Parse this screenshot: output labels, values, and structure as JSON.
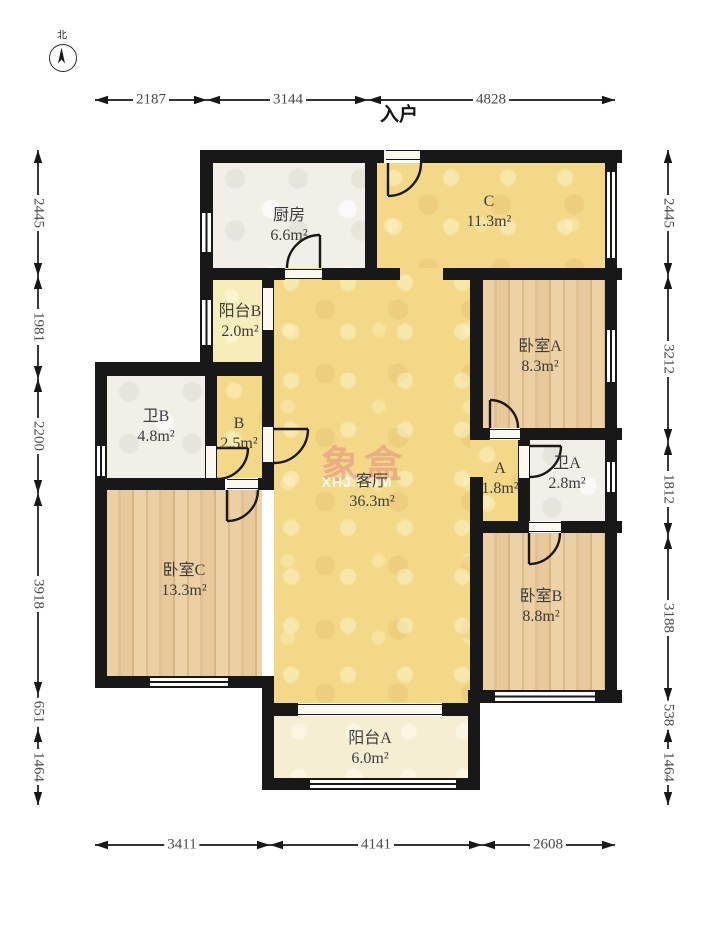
{
  "compass": {
    "label": "北"
  },
  "entry": {
    "label": "入户"
  },
  "watermark": {
    "line1": "象盒",
    "line2": "XHJ.COM"
  },
  "rooms": [
    {
      "id": "kitchen",
      "name": "厨房",
      "area": "6.6m²"
    },
    {
      "id": "hall-c",
      "name": "C",
      "area": "11.3m²"
    },
    {
      "id": "balcony-b",
      "name": "阳台B",
      "area": "2.0m²"
    },
    {
      "id": "bedroom-a",
      "name": "卧室A",
      "area": "8.3m²"
    },
    {
      "id": "bath-b",
      "name": "卫B",
      "area": "4.8m²"
    },
    {
      "id": "hall-b",
      "name": "B",
      "area": "2.5m²"
    },
    {
      "id": "living",
      "name": "客厅",
      "area": "36.3m²"
    },
    {
      "id": "hall-a",
      "name": "A",
      "area": "1.8m²"
    },
    {
      "id": "bath-a",
      "name": "卫A",
      "area": "2.8m²"
    },
    {
      "id": "bedroom-c",
      "name": "卧室C",
      "area": "13.3m²"
    },
    {
      "id": "bedroom-b",
      "name": "卧室B",
      "area": "8.8m²"
    },
    {
      "id": "balcony-a",
      "name": "阳台A",
      "area": "6.0m²"
    }
  ],
  "dimensions": {
    "top": [
      "2187",
      "3144",
      "4828"
    ],
    "bottom": [
      "3411",
      "4141",
      "2608"
    ],
    "left": [
      "2445",
      "1981",
      "2200",
      "3918",
      "651",
      "1464"
    ],
    "right": [
      "2445",
      "3212",
      "1812",
      "3188",
      "538",
      "1464"
    ]
  },
  "colors": {
    "wall": "#181818",
    "floor_yellow": "#f3d987",
    "floor_wood": "#e5c494",
    "floor_tile": "#f1efe8",
    "watermark_pink": "#de8080"
  }
}
